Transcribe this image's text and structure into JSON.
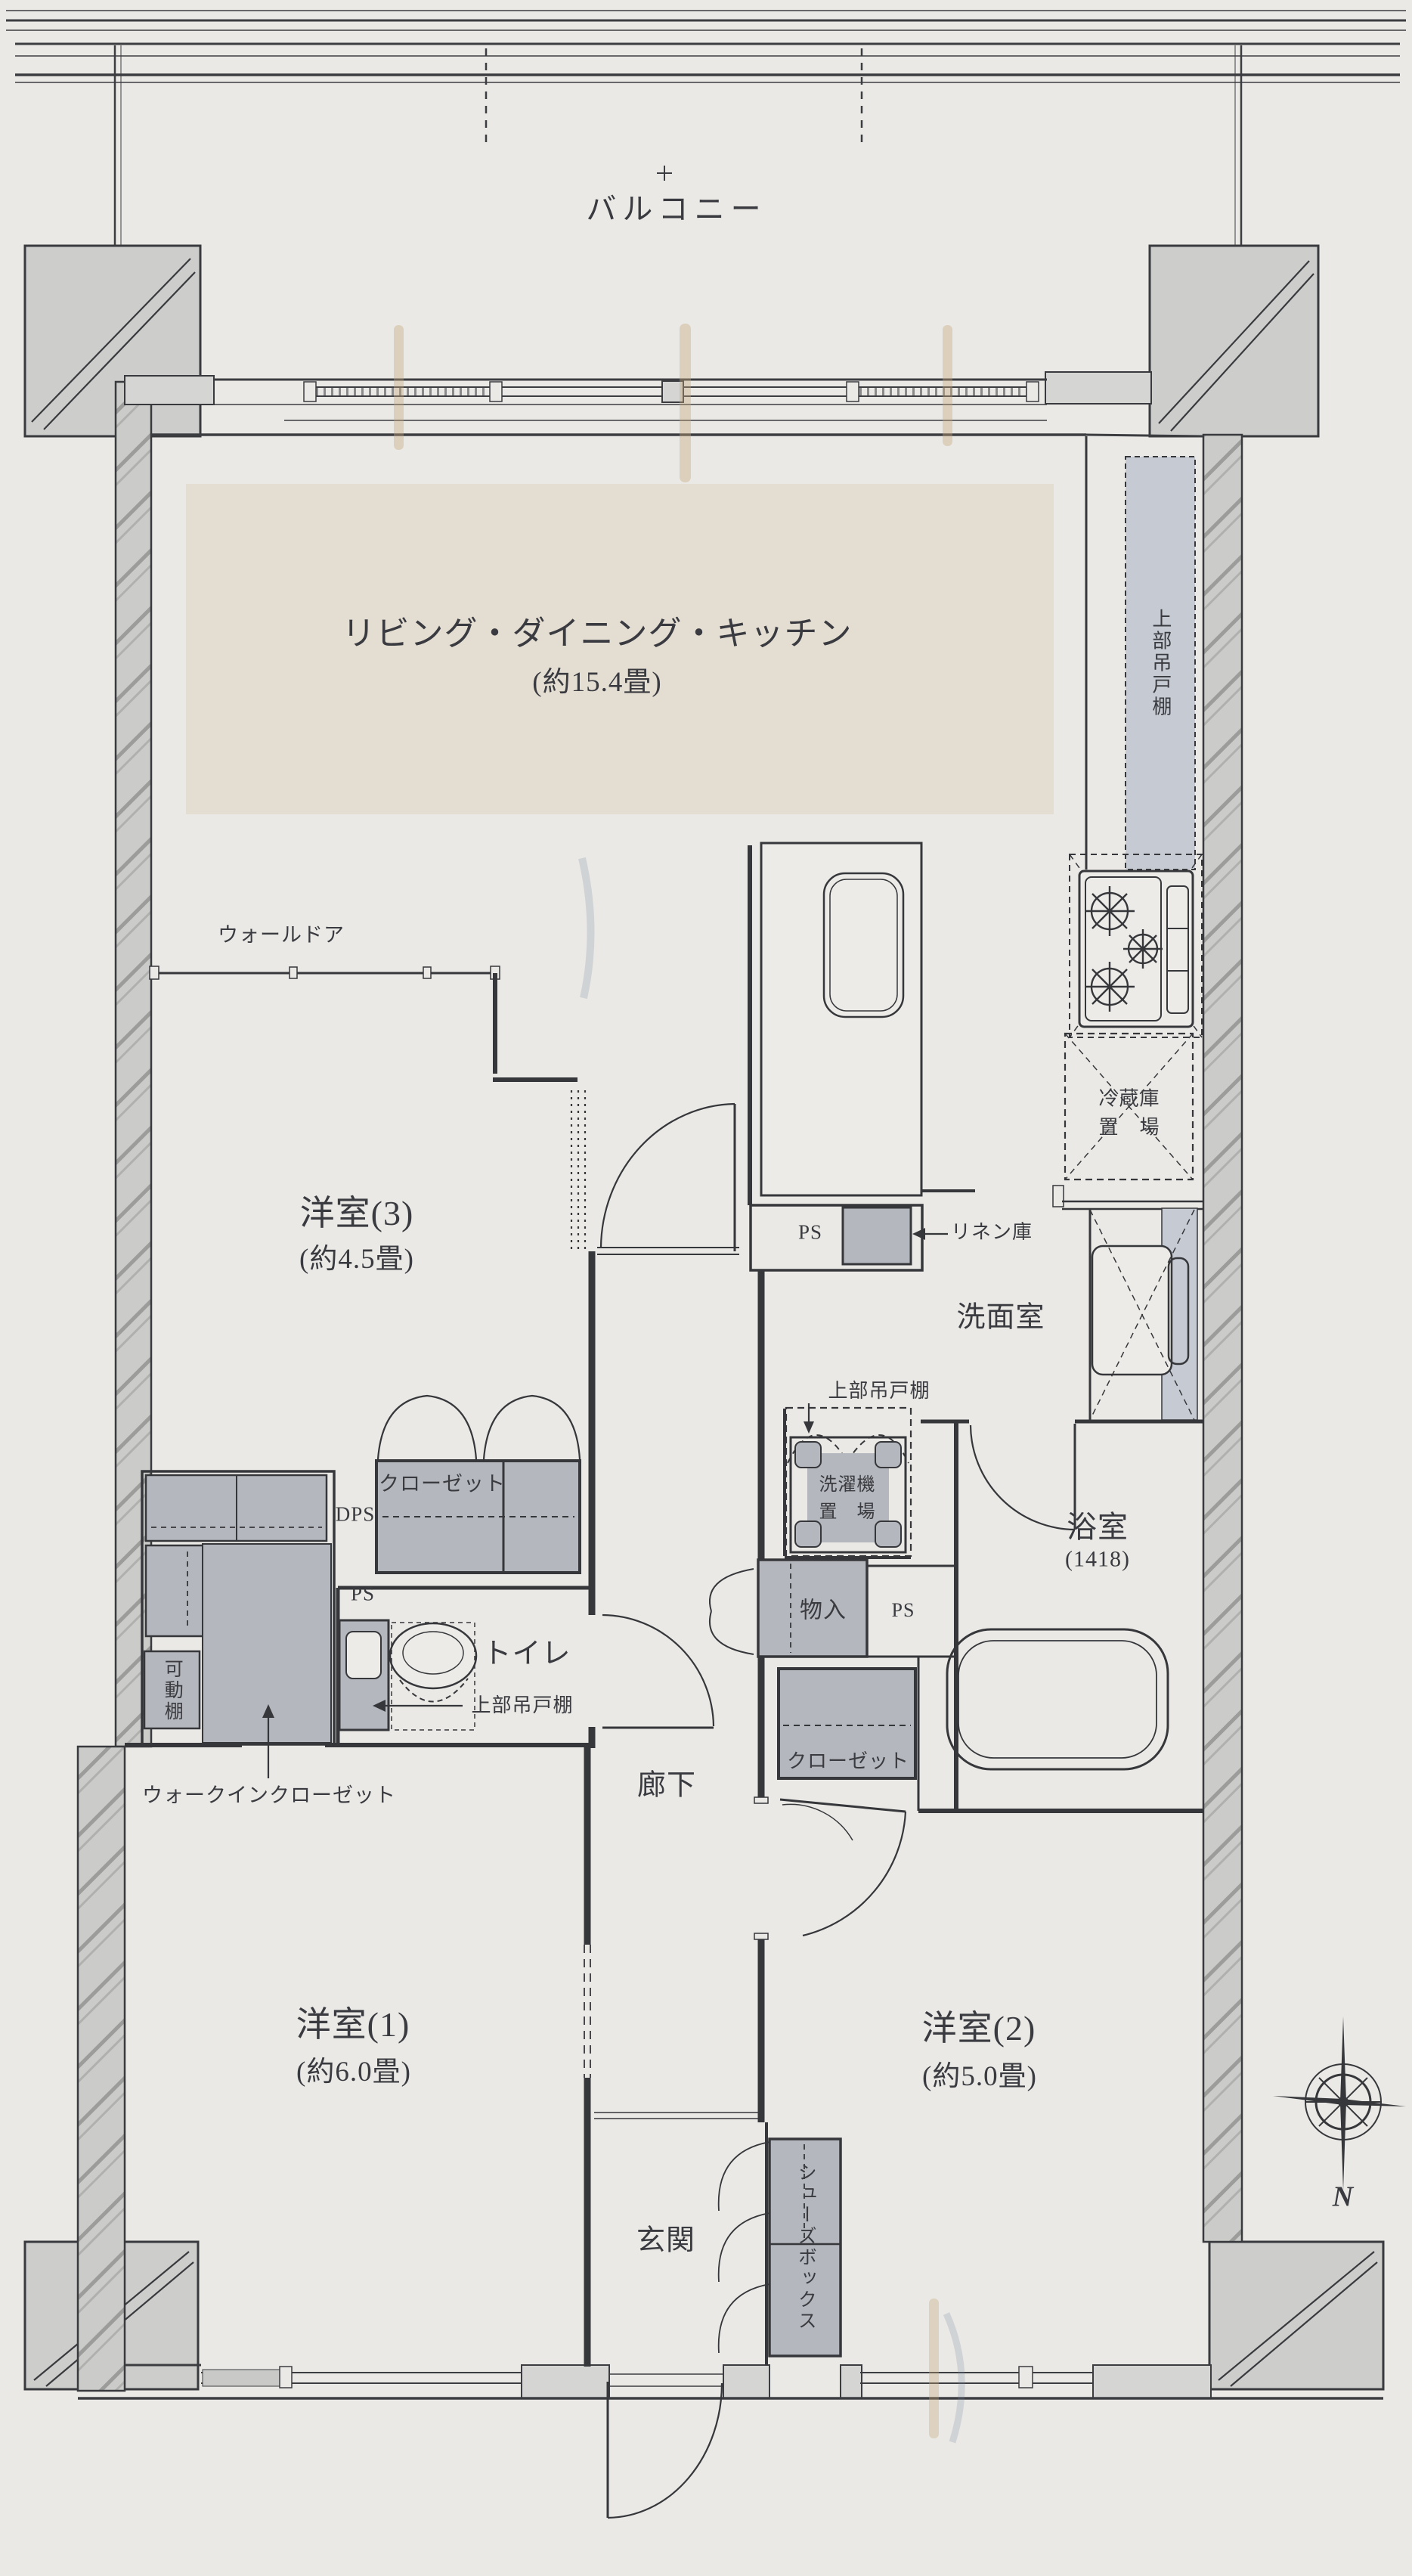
{
  "plan": {
    "balcony": "バルコニー",
    "compass_north": "N",
    "rooms": {
      "ldk": {
        "name": "リビング・ダイニング・キッチン",
        "size": "(約15.4畳)"
      },
      "western_3": {
        "name": "洋室(3)",
        "size": "(約4.5畳)"
      },
      "western_1": {
        "name": "洋室(1)",
        "size": "(約6.0畳)"
      },
      "western_2": {
        "name": "洋室(2)",
        "size": "(約5.0畳)"
      },
      "washroom": {
        "name": "洗面室"
      },
      "bathroom": {
        "name": "浴室",
        "size": "(1418)"
      },
      "toilet": {
        "name": "トイレ"
      },
      "hallway": {
        "name": "廊下"
      },
      "entrance": {
        "name": "玄関"
      }
    },
    "fixtures": {
      "wall_door": "ウォールドア",
      "closet": "クローゼット",
      "walk_in_closet": "ウォークインクローゼット",
      "movable_shelf": "可動棚",
      "dps": "DPS",
      "ps": "PS",
      "linen_storage": "リネン庫",
      "upper_cabinet": "上部吊戸棚",
      "fridge_space": "冷蔵庫\n置　場",
      "washer_space": "洗濯機\n置　場",
      "hall_storage": "物入",
      "shoe_box": "シューズボックス"
    },
    "colors": {
      "paper": "#eae9e5",
      "ink": "#36373b",
      "wall_fill": "#cbccc9",
      "gray_box": "#b4b7bd",
      "light_gray": "#c6cad2",
      "beige": "#e4ddd2"
    }
  }
}
